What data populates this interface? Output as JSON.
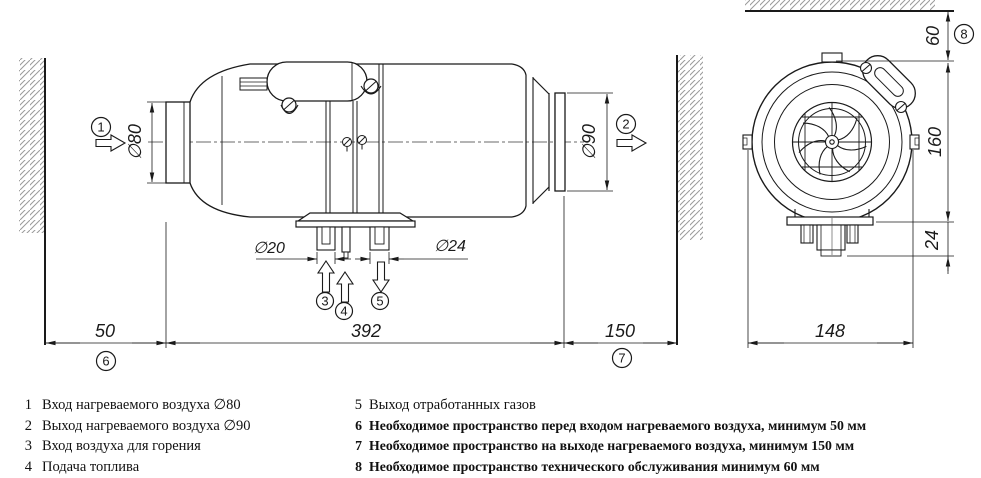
{
  "drawing": {
    "dims": {
      "d80": "∅80",
      "d90": "∅90",
      "d20": "∅20",
      "d24": "∅24",
      "len50": "50",
      "len392": "392",
      "len150": "150",
      "len148": "148",
      "len60": "60",
      "len160": "160",
      "len24": "24"
    },
    "callouts": {
      "c1": "1",
      "c2": "2",
      "c3": "3",
      "c4": "4",
      "c5": "5",
      "c6": "6",
      "c7": "7",
      "c8": "8"
    },
    "colors": {
      "line": "#1a1a1a",
      "hatch": "#9a9a9a",
      "background": "#ffffff"
    }
  },
  "legend": {
    "left": [
      {
        "num": "1",
        "text": "Вход нагреваемого воздуха ∅80"
      },
      {
        "num": "2",
        "text": "Выход нагреваемого воздуха ∅90"
      },
      {
        "num": "3",
        "text": "Вход воздуха для горения"
      },
      {
        "num": "4",
        "text": "Подача топлива"
      }
    ],
    "right": [
      {
        "num": "5",
        "text": "Выход отработанных газов"
      },
      {
        "num": "6",
        "text": "Необходимое пространство перед входом нагреваемого воздуха, минимум 50 мм"
      },
      {
        "num": "7",
        "text": "Необходимое пространство на выходе нагреваемого воздуха, минимум 150 мм"
      },
      {
        "num": "8",
        "text": "Необходимое пространство технического обслуживания минимум 60 мм"
      }
    ]
  }
}
